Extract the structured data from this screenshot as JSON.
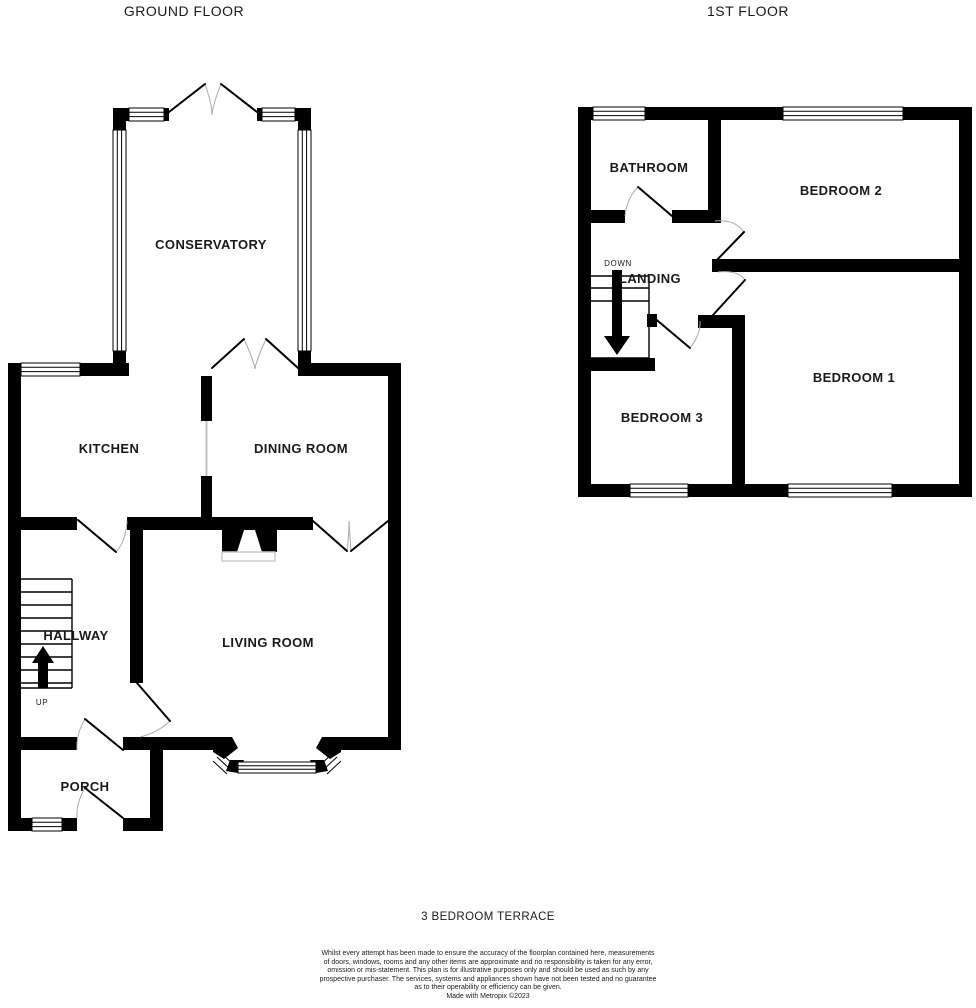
{
  "ground_floor": {
    "title": "GROUND FLOOR",
    "rooms": {
      "conservatory": "CONSERVATORY",
      "kitchen": "KITCHEN",
      "dining_room": "DINING ROOM",
      "hallway": "HALLWAY",
      "living_room": "LIVING ROOM",
      "porch": "PORCH"
    },
    "stairs_label": "UP"
  },
  "first_floor": {
    "title": "1ST FLOOR",
    "rooms": {
      "bathroom": "BATHROOM",
      "bedroom_2": "BEDROOM 2",
      "landing": "LANDING",
      "bedroom_1": "BEDROOM 1",
      "bedroom_3": "BEDROOM 3"
    },
    "stairs_label": "DOWN"
  },
  "footer": {
    "property_type": "3 BEDROOM TERRACE",
    "disclaimer_lines": [
      "Whilst every attempt has been made to ensure the accuracy of the floorplan contained here, measurements",
      "of doors, windows, rooms and any other items are approximate and no responsibility is taken for any error,",
      "omission or mis-statement. This plan is for illustrative purposes only and should be used as such by any",
      "prospective purchaser. The services, systems and appliances shown have not been tested and no guarantee",
      "as to their operability or efficiency can be given."
    ],
    "credit": "Made with Metropix ©2023"
  },
  "colors": {
    "wall": "#000000",
    "door_arc": "#aaaaaa",
    "background": "#ffffff"
  }
}
